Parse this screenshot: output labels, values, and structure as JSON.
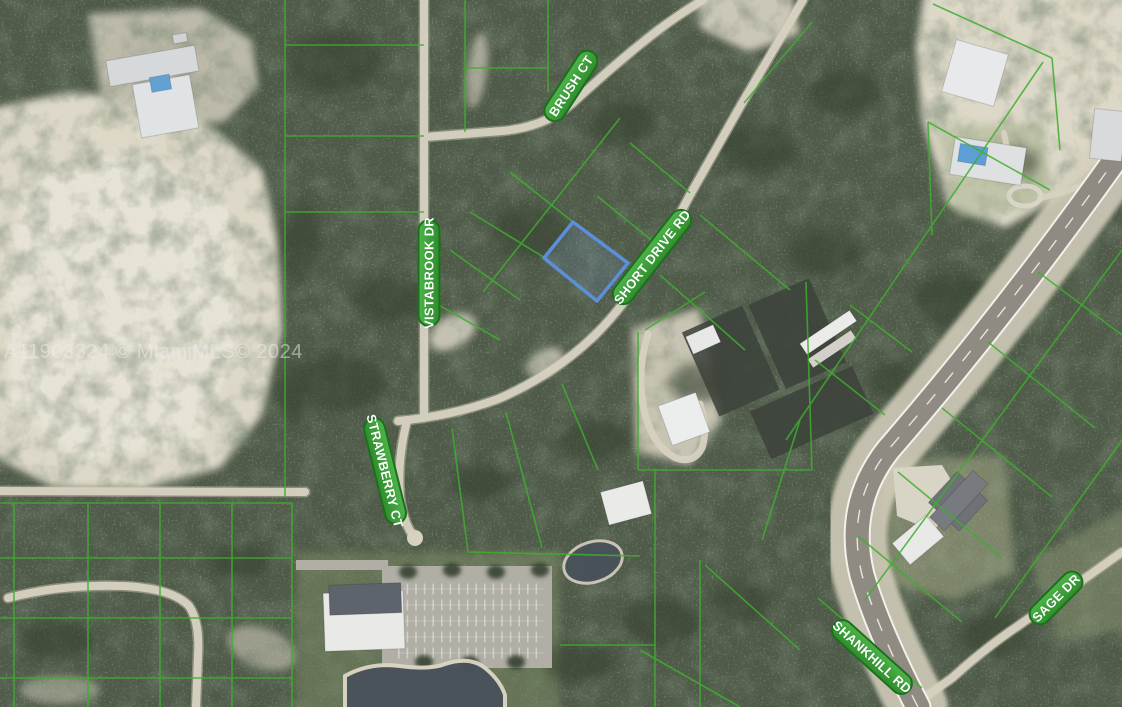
{
  "watermark": {
    "text": "A11903324 © MiamiMLS© 2024"
  },
  "map": {
    "type": "aerial-satellite-parcel-map",
    "street_labels": [
      {
        "name": "BRUSH CT",
        "x": 571,
        "y": 86,
        "rotate": -57,
        "width": 80
      },
      {
        "name": "VISTABROOK DR",
        "x": 429,
        "y": 273,
        "rotate": -90,
        "width": 106
      },
      {
        "name": "SHORT DRIVE RD",
        "x": 652,
        "y": 257,
        "rotate": -52,
        "width": 114
      },
      {
        "name": "STRAWBERRY CT",
        "x": 385,
        "y": 471,
        "rotate": 76,
        "width": 108
      },
      {
        "name": "SHANKHILL RD",
        "x": 872,
        "y": 657,
        "rotate": 42,
        "width": 100
      },
      {
        "name": "SAGE DR",
        "x": 1056,
        "y": 598,
        "rotate": -45,
        "width": 66
      }
    ],
    "highlighted_parcel": {
      "points": "573,222 628,263 597,301 544,258",
      "fill": "rgba(125,162,224,0.16)"
    },
    "colors": {
      "parcel_line": "#3eae2e",
      "street_label_fill_top": "#4cb449",
      "street_label_fill_bottom": "#2e8d2c",
      "street_label_border": "#1d6f1d",
      "street_label_text": "#ffffff",
      "vegetation": "#4f5a49",
      "sand": "#ddd8c8",
      "dirt_road": "#d7d1c1",
      "paved_road": "#8f8b82",
      "water": "#48525a",
      "highlight_blue": "#5b8fd9"
    }
  }
}
